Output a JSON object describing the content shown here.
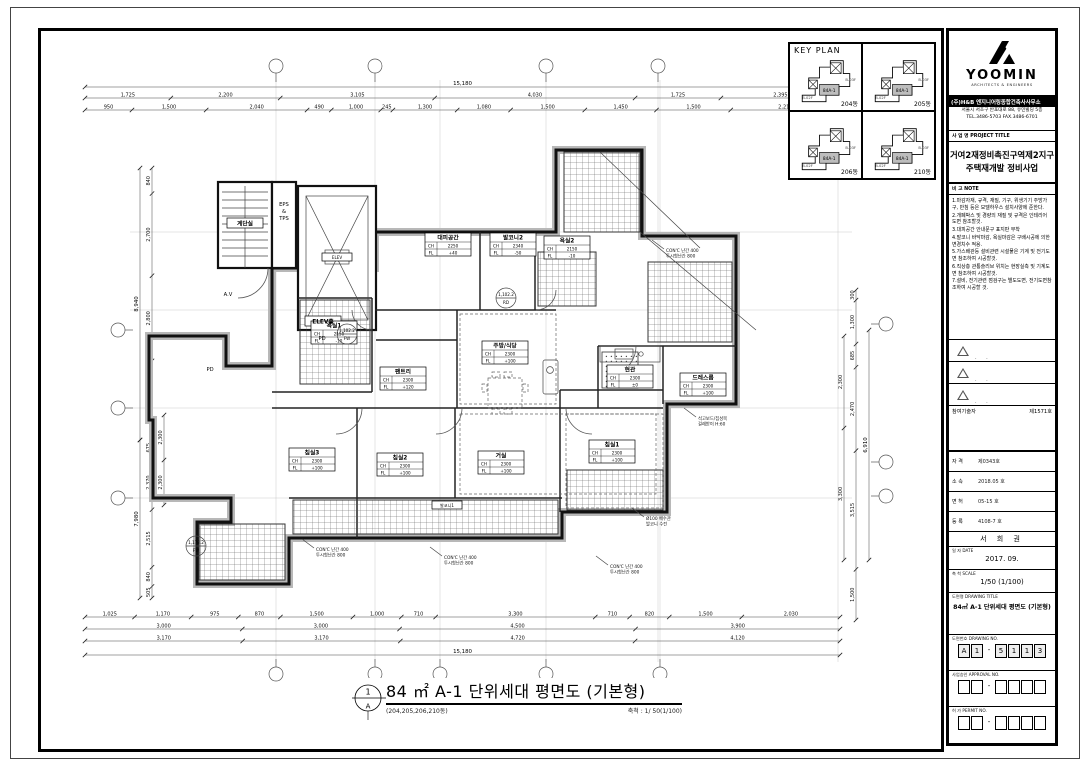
{
  "key_plan": {
    "title": "KEY PLAN",
    "unit_tag": "84A-1",
    "code_a": "B-03F",
    "code_b": "B-02F",
    "cells": [
      {
        "name": "204동"
      },
      {
        "name": "205동"
      },
      {
        "name": "206동"
      },
      {
        "name": "210동"
      }
    ]
  },
  "title_block": {
    "logo_word": "YOOMIN",
    "logo_sub": "ARCHITECTS & ENGINEERS",
    "firm_name": "(주)H&B 엔지니어링종합건축사사무소",
    "firm_addr1": "서울시 서초구 반포대로 88, 유민빌딩 5층",
    "firm_addr2": "TEL.3486-5703  FAX.3486-6701",
    "project_head": "사 업 명   PROJECT TITLE",
    "project_line1": "거여2재정비촉진구역제2지구",
    "project_line2": "주택재개발 정비사업",
    "note_head": "비 고   NOTE",
    "notes": [
      "1.마감자재, 규격, 재질, 기구, 위생기기 주방가구, 반침 등은 모델하우스 설치사양에 준한다.",
      "2.개폐박스 및 경량의 재질 및 규격은 인테리어 도면 참조할것.",
      "3.대피공간 안내문구 표지판 부착",
      "4.발코니 바닥마감, 욕실마감은 구배시공에 의한 변경치수 적용.",
      "5.가스배관등 설비관련 시설물은 기계 및 전기도면 참조하여 시공할것.",
      "6.직상층 관통슬리브 위치는 현장실측 및 기계도면 참조하여 시공할것.",
      "7.설비, 전기관련 점검구는 별도도면, 전기도면참조하여 시공할 것."
    ],
    "revision_count": 3,
    "field_a_label": "참여기술자",
    "field_a_value": "제1571호",
    "fields": [
      {
        "label": "자 격",
        "value": "제0343호"
      },
      {
        "label": "소 속",
        "value": "2018.05 호"
      },
      {
        "label": "면 허",
        "value": "05-15 호"
      },
      {
        "label": "등 록",
        "value": "4108-7 호"
      }
    ],
    "approver_name": "서 희 권",
    "date_head": "일 자  DATE",
    "date_value": "2017. 09.",
    "scale_head": "축 척  SCALE",
    "scale_value": "1/50 (1/100)",
    "dwgtitle_head": "도면명  DRAWING TITLE",
    "dwgtitle_value": "84㎡ A-1 단위세대 평면도 (기본형)",
    "no_rows": [
      {
        "head": "도면번호  DRAWING NO.",
        "boxes": [
          "A",
          "1",
          "-",
          "5",
          "1",
          "1",
          "3"
        ]
      },
      {
        "head": "사업승인  APPROVAL NO.",
        "boxes": [
          "",
          "",
          "-",
          "",
          "",
          "",
          ""
        ]
      },
      {
        "head": "허 가  PERMIT NO.",
        "boxes": [
          "",
          "",
          "-",
          "",
          "",
          "",
          ""
        ]
      }
    ]
  },
  "drawing_title": {
    "mark_top": "1",
    "mark_bottom": "A",
    "title": "84 ㎡ A-1 단위세대 평면도 (기본형)",
    "sub": "(204,205,206,210동)",
    "scale": "축척 : 1/ 50(1/100)"
  },
  "plan": {
    "rooms": [
      {
        "name": "계단실",
        "x": 245,
        "y": 224,
        "style": "name"
      },
      {
        "name": "ELEV",
        "x": 337,
        "y": 258,
        "style": "name-s"
      },
      {
        "name": "ELEV홀",
        "x": 323,
        "y": 322,
        "style": "name"
      },
      {
        "name": "대피공간",
        "x": 448,
        "y": 238,
        "ch": "2250",
        "fl": "+40",
        "style": "full"
      },
      {
        "name": "발코니2",
        "x": 513,
        "y": 238,
        "ch": "2340",
        "fl": "-50",
        "style": "full"
      },
      {
        "name": "욕실2",
        "x": 567,
        "y": 241,
        "ch": "2150",
        "fl": "-10",
        "style": "full"
      },
      {
        "name": "욕실1",
        "x": 334,
        "y": 326,
        "ch": "2150",
        "fl": "-10",
        "style": "full"
      },
      {
        "name": "주방/식당",
        "x": 505,
        "y": 346,
        "ch": "2300",
        "fl": "+100",
        "style": "full"
      },
      {
        "name": "팬트리",
        "x": 403,
        "y": 372,
        "ch": "2300",
        "fl": "+120",
        "style": "full"
      },
      {
        "name": "현관",
        "x": 630,
        "y": 370,
        "ch": "2300",
        "fl": "±0",
        "style": "full"
      },
      {
        "name": "드레스룸",
        "x": 703,
        "y": 378,
        "ch": "2300",
        "fl": "+100",
        "style": "full"
      },
      {
        "name": "침실1",
        "x": 612,
        "y": 445,
        "ch": "2300",
        "fl": "+100",
        "style": "full"
      },
      {
        "name": "거실",
        "x": 501,
        "y": 456,
        "ch": "2300",
        "fl": "+100",
        "style": "full"
      },
      {
        "name": "침실2",
        "x": 400,
        "y": 458,
        "ch": "2300",
        "fl": "+100",
        "style": "full"
      },
      {
        "name": "침실3",
        "x": 312,
        "y": 453,
        "ch": "2300",
        "fl": "+100",
        "style": "full"
      },
      {
        "name": "발코니1",
        "x": 447,
        "y": 506,
        "style": "name-s"
      }
    ],
    "texts": [
      {
        "t": "EPS",
        "x": 284,
        "y": 206
      },
      {
        "t": "&",
        "x": 284,
        "y": 213
      },
      {
        "t": "TPS",
        "x": 284,
        "y": 220
      },
      {
        "t": "A.V",
        "x": 228,
        "y": 296
      },
      {
        "t": "PD",
        "x": 322,
        "y": 340
      },
      {
        "t": "PD",
        "x": 210,
        "y": 371
      }
    ],
    "levels": [
      {
        "x": 347,
        "y": 334,
        "a": "1,102.2",
        "b": "FW"
      },
      {
        "x": 196,
        "y": 546,
        "a": "1,178.2",
        "b": "FW"
      },
      {
        "x": 506,
        "y": 298,
        "a": "1,102.2",
        "b": "RD"
      }
    ],
    "callouts": [
      {
        "x": 318,
        "y": 551,
        "lines": [
          "CON'C 난간 400",
          "투시형난간 800"
        ]
      },
      {
        "x": 446,
        "y": 559,
        "lines": [
          "CON'C 난간 400",
          "투시형난간 800"
        ]
      },
      {
        "x": 612,
        "y": 568,
        "lines": [
          "CON'C 난간 400",
          "투시형난간 800"
        ]
      },
      {
        "x": 648,
        "y": 520,
        "lines": [
          "Ø100 배수관",
          "발코니 수전"
        ]
      },
      {
        "x": 700,
        "y": 420,
        "lines": [
          "석고보드/집성목",
          "걸레받이 H:60"
        ]
      },
      {
        "x": 668,
        "y": 252,
        "lines": [
          "CON'C 난간 400",
          "투시형난간 800"
        ]
      }
    ],
    "dims": {
      "top": {
        "total": "15,180",
        "row1": [
          "1,725",
          "2,200",
          "3,105",
          "4,030",
          "1,725",
          "2,395"
        ],
        "row2": [
          "950",
          "1,500",
          "2,040",
          "490",
          "1,000",
          "245",
          "1,300",
          "1,080",
          "1,500",
          "1,450",
          "1,500",
          "2,210"
        ]
      },
      "bottom": {
        "row_inner": [
          "1,025",
          "1,170",
          "975",
          "870",
          "1,500",
          "1,000",
          "710",
          "3,300",
          "710",
          "820",
          "1,500",
          "2,030"
        ],
        "row_mid": [
          "3,000",
          "3,000",
          "4,500",
          "3,900"
        ],
        "row_outer": [
          "3,170",
          "3,170",
          "4,720",
          "4,120"
        ],
        "total": "15,180"
      },
      "left": {
        "upper_total": "8,940",
        "upper": [
          "840",
          "2,700",
          "2,800",
          "2,600"
        ],
        "lower_total": "7,980",
        "lower": [
          "675",
          "2,370",
          "2,515",
          "840",
          "505"
        ],
        "inner": [
          "2,300",
          "2,300"
        ]
      },
      "right": {
        "total": "6,910",
        "segs": [
          "300",
          "1,300",
          "685",
          "2,470",
          "3,515",
          "1,500"
        ],
        "inner": [
          "2,300",
          "3,300"
        ]
      }
    },
    "grid": {
      "top_x": [
        276,
        375,
        546,
        658,
        838
      ],
      "bottom_x": [
        276,
        375,
        440,
        546,
        660
      ],
      "left_y": [
        330,
        408,
        498
      ],
      "right_y": [
        324,
        462,
        496
      ]
    }
  }
}
